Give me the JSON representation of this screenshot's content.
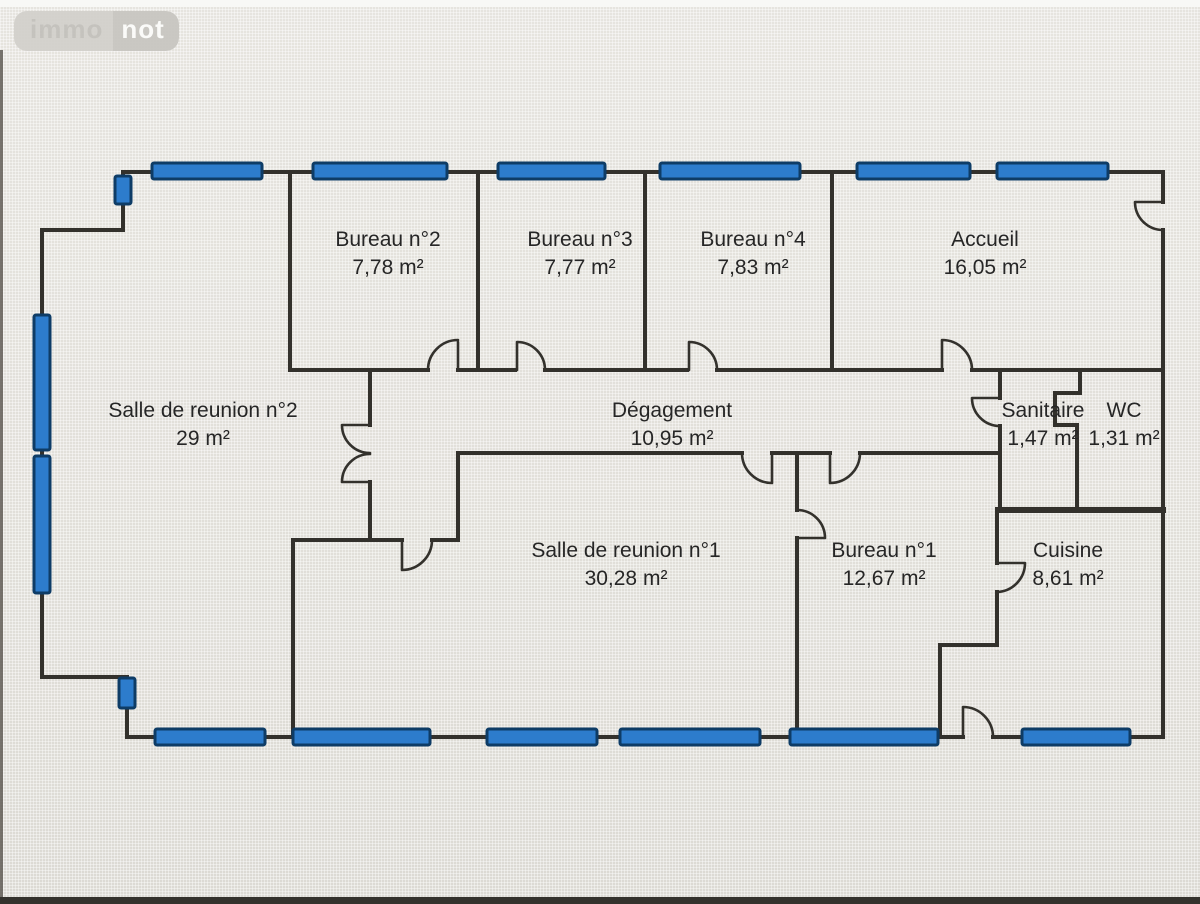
{
  "logo": {
    "left": "immo",
    "right": "not"
  },
  "rooms": [
    {
      "id": "bureau-2",
      "label": "Bureau n°2",
      "area": "7,78  m²"
    },
    {
      "id": "bureau-3",
      "label": "Bureau n°3",
      "area": "7,77  m²"
    },
    {
      "id": "bureau-4",
      "label": "Bureau n°4",
      "area": "7,83  m²"
    },
    {
      "id": "accueil",
      "label": "Accueil",
      "area": "16,05  m²"
    },
    {
      "id": "salle-reunion-2",
      "label": "Salle de reunion n°2",
      "area": "29  m²"
    },
    {
      "id": "degagement",
      "label": "Dégagement",
      "area": "10,95  m²"
    },
    {
      "id": "sanitaire",
      "label": "Sanitaire",
      "area": "1,47  m²"
    },
    {
      "id": "wc",
      "label": "WC",
      "area": "1,31  m²"
    },
    {
      "id": "salle-reunion-1",
      "label": "Salle de reunion n°1",
      "area": "30,28  m²"
    },
    {
      "id": "bureau-1",
      "label": "Bureau n°1",
      "area": "12,67  m²"
    },
    {
      "id": "cuisine",
      "label": "Cuisine",
      "area": "8,61  m²"
    }
  ],
  "colors": {
    "wall": "#33312c",
    "window_fill": "#2d7ccc",
    "window_border": "#0e3c66",
    "text": "#262626",
    "background": "#e6e4df"
  }
}
